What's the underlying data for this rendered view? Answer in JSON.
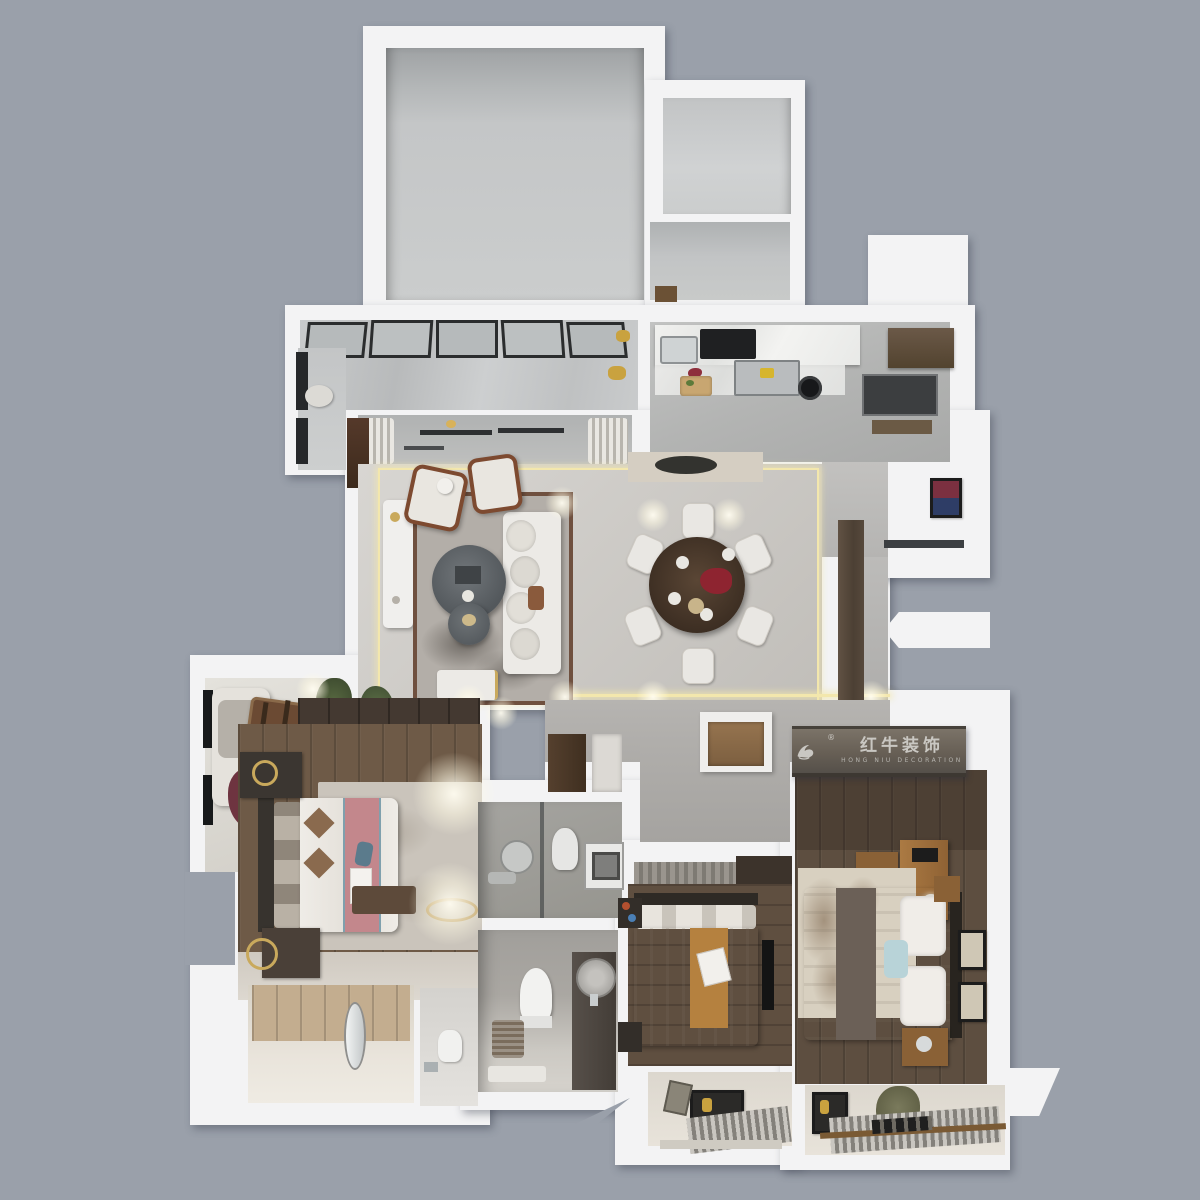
{
  "brand": {
    "name_cn": "红牛装饰",
    "name_en": "HONG NIU DECORATION",
    "registered": "®"
  },
  "colors": {
    "background": "#9aa0aa",
    "wall_white": "#f3f3f4",
    "accent_light_line": "#f3e7ad",
    "concrete_floor": "#c6c8c9",
    "gray_tile": "#b9bab9",
    "warm_tile": "#cbc8c3",
    "wood_dark": "#5d4e40",
    "wood_master": "#6e5a47",
    "wood_light_closet": "#c3ad8f",
    "rug_gray": "#b3aea8",
    "rug_border_brown": "#6f503f",
    "bed_runner_pink": "#c3878c",
    "bed_runner_orange": "#b5813f",
    "bed_runner_taupe": "#6b6057",
    "dining_table_wood": "#4c3b2d",
    "logo_band": "#675f55",
    "logo_text": "#c9c7c2",
    "window_frame_black": "#2b2d2e",
    "gold_decor": "#c9a95c"
  }
}
